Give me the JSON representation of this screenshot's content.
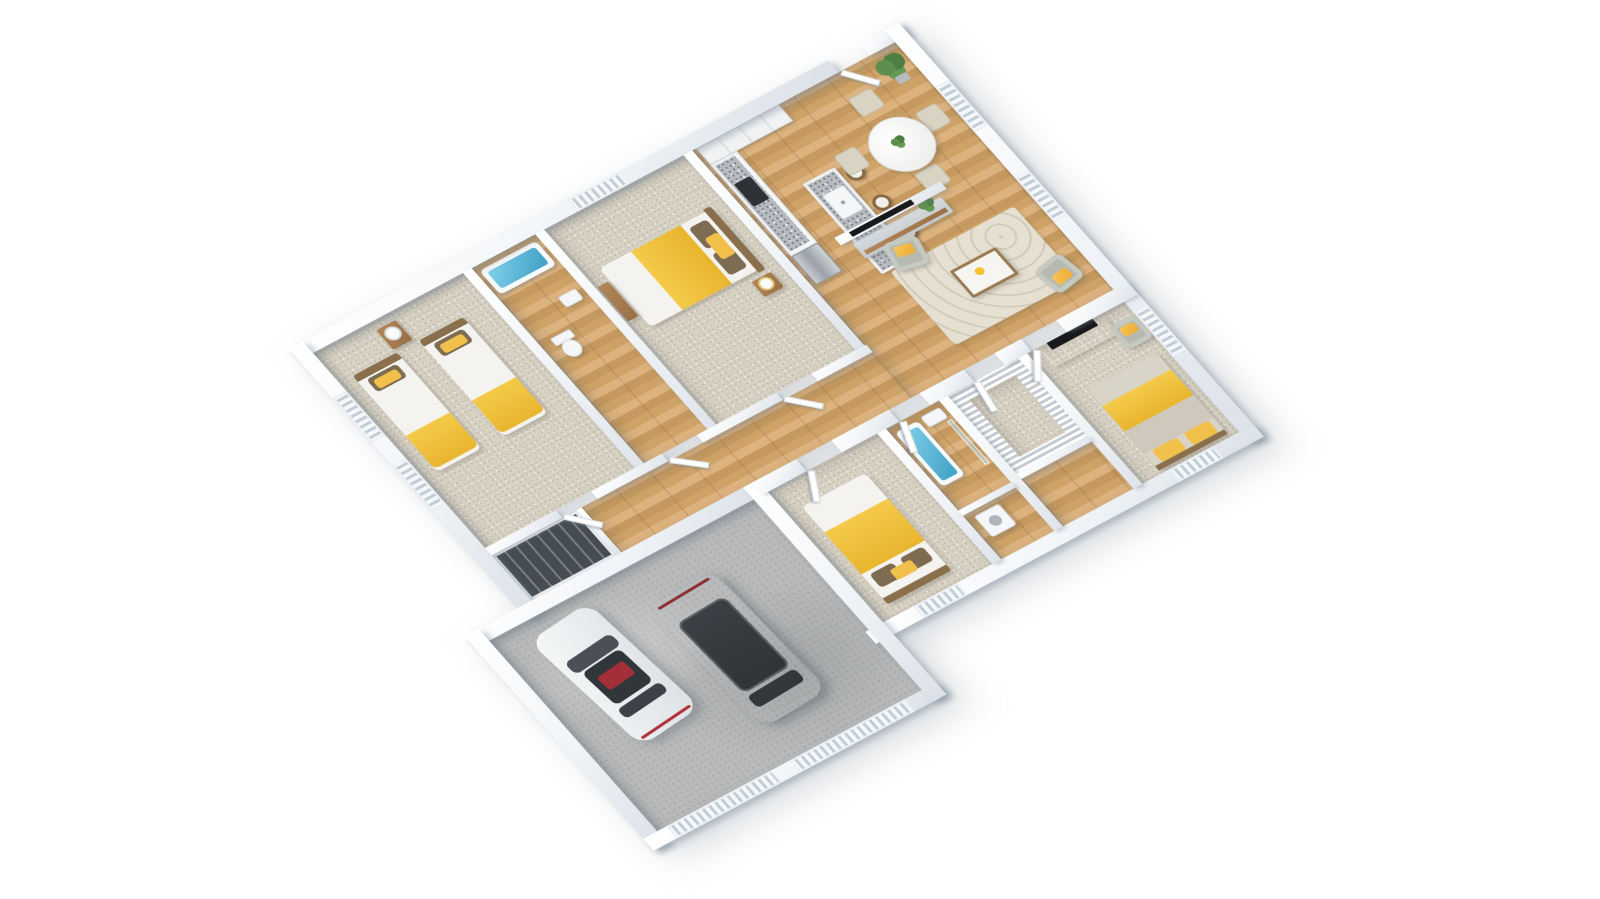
{
  "scene": {
    "type": "3d-floorplan-render",
    "description": "Isometric 3D dollhouse-view floor plan of a single-story house with attached two-car garage, white walls, wood and carpet floors, yellow accent bedding",
    "background": "#ffffff"
  },
  "palette": {
    "wall": "#f0f3f6",
    "wall_shadow": "#dbe1e8",
    "wood_floor": "#d2a66e",
    "carpet": "#d7d1c3",
    "garage_concrete": "#b7b9ba",
    "granite_counter": "#b6bbc0",
    "accent_yellow": "#f0c243",
    "tub_water": "#4fb0d4",
    "plant_green": "#4e7f42",
    "rug": "#e6e0d2",
    "wood_furniture": "#a97c4f",
    "white_car": "#eef0f1",
    "gray_car": "#5b5f63"
  },
  "rooms": [
    {
      "name": "twin bedroom",
      "floor": "carpet",
      "furniture": [
        "twin bed with yellow blanket",
        "twin bed with yellow blanket",
        "nightstand with round lamp"
      ]
    },
    {
      "name": "hall bathroom",
      "floor": "wood",
      "furniture": [
        "bathtub with water",
        "toilet",
        "sink"
      ]
    },
    {
      "name": "bedroom 2",
      "floor": "carpet",
      "furniture": [
        "double bed with yellow blanket",
        "wood bench",
        "nightstand with lamp"
      ]
    },
    {
      "name": "kitchen",
      "floor": "wood",
      "furniture": [
        "wall cabinets",
        "granite counter with cooktop",
        "refrigerator",
        "granite island with sink",
        "bar stool",
        "bar stool",
        "bar stool"
      ]
    },
    {
      "name": "dining area",
      "floor": "wood",
      "furniture": [
        "round white dining table",
        "dining chair",
        "dining chair",
        "dining chair",
        "dining chair",
        "potted plant",
        "table centerpiece plant"
      ]
    },
    {
      "name": "living room",
      "floor": "wood",
      "furniture": [
        "tv wall niche",
        "media console with plant",
        "area rug",
        "coffee table with yellow bowl",
        "armchair with yellow cushion",
        "armchair with yellow cushion"
      ]
    },
    {
      "name": "hallway",
      "floor": "wood",
      "furniture": [
        "interior doors"
      ]
    },
    {
      "name": "hall closet",
      "floor": "dark sliding doors",
      "furniture": []
    },
    {
      "name": "utility closet",
      "floor": "carpet with shelving",
      "furniture": [
        "perimeter shelves"
      ]
    },
    {
      "name": "bedroom 3",
      "floor": "carpet",
      "furniture": [
        "double bed with yellow blanket and brown pillows"
      ]
    },
    {
      "name": "bathroom 2",
      "floor": "wood",
      "furniture": [
        "bathtub with water",
        "sink",
        "glass shower panel"
      ]
    },
    {
      "name": "laundry closet",
      "floor": "wood",
      "furniture": [
        "washer"
      ]
    },
    {
      "name": "master bedroom",
      "floor": "carpet",
      "furniture": [
        "double bed with yellow blanket and yellow pillows",
        "dresser with tv",
        "armchair with yellow cushion"
      ]
    },
    {
      "name": "garage",
      "floor": "concrete",
      "furniture": [
        "white sedan",
        "gray suv"
      ]
    }
  ],
  "vehicles": [
    {
      "name": "white sedan",
      "color": "#eef0f1",
      "detail": "dark sunroof with red cabin visible"
    },
    {
      "name": "gray suv",
      "color": "#5b5f63",
      "detail": "dark panoramic glass roof"
    }
  ]
}
